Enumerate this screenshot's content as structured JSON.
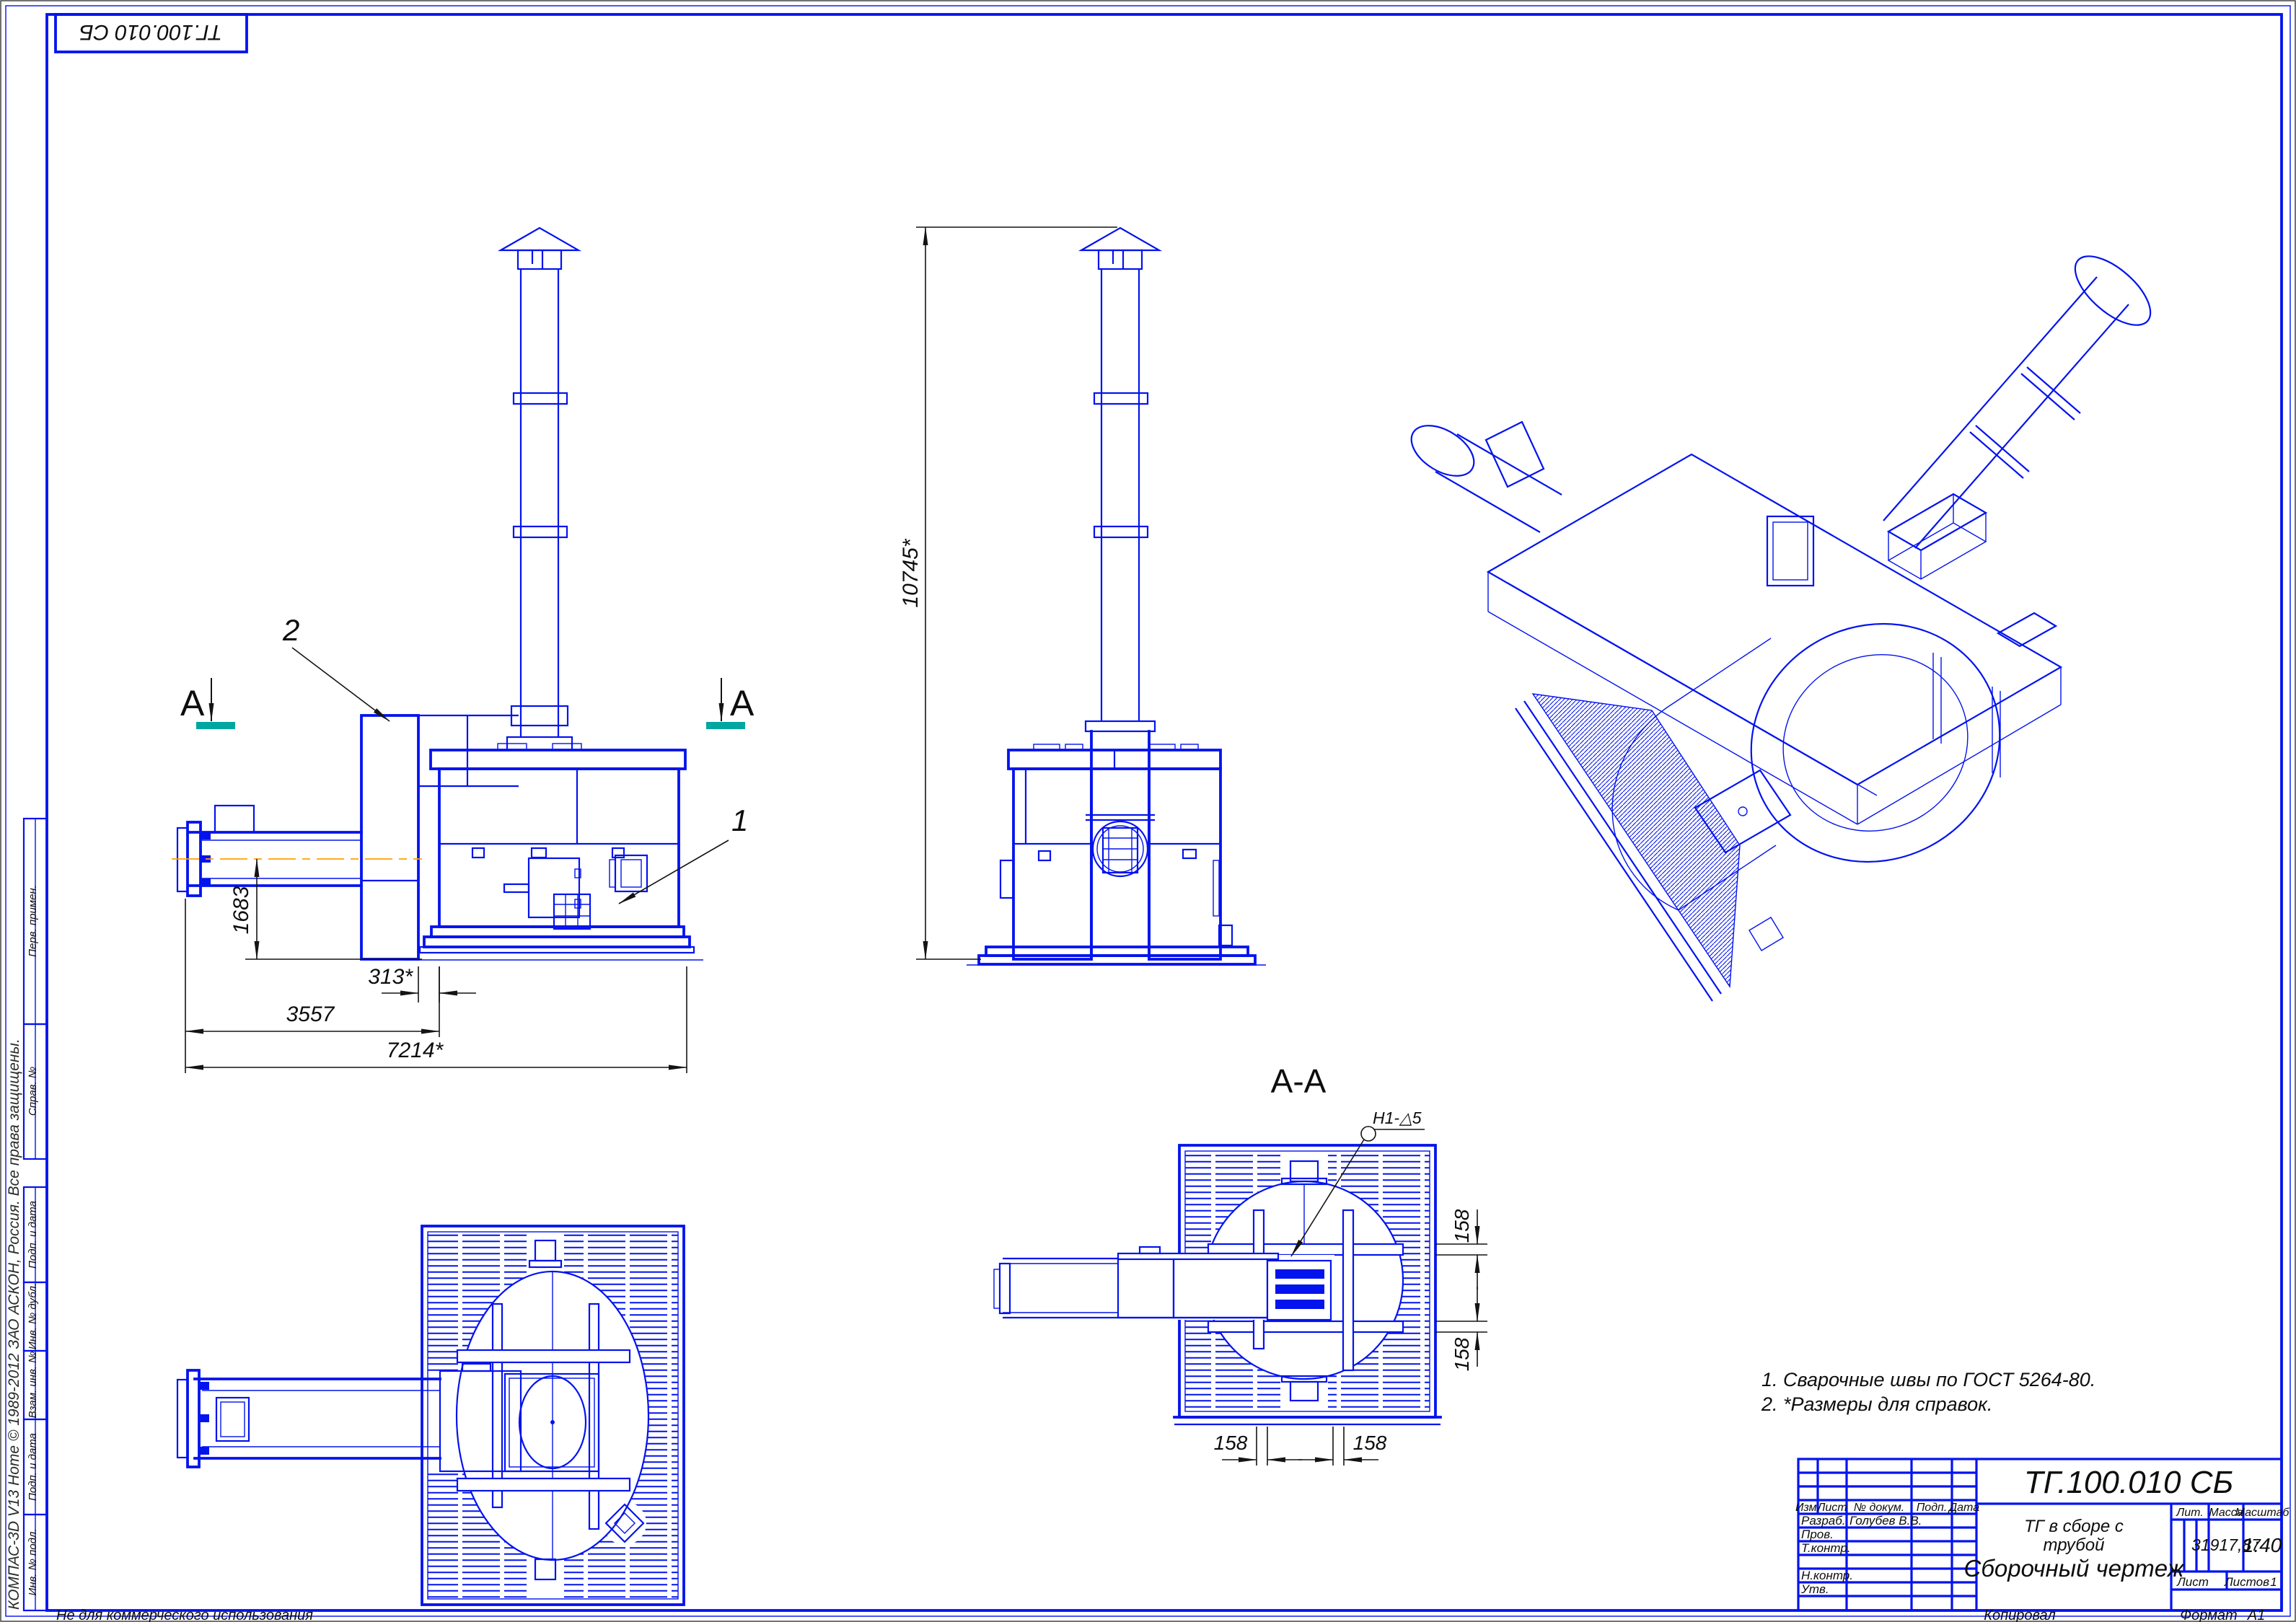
{
  "sheet": {
    "stamp_top_left": "ТГ.100.010 СБ",
    "watermark": "КОМПАС-3D V13 Home © 1989-2012 ЗАО АСКОН, Россия. Все права защищены.",
    "footer_note": "Не для коммерческого использования",
    "kopiroval": "Копировал",
    "format_label": "Формат",
    "format_value": "А1"
  },
  "frame_labels": [
    "Перв. примен.",
    "Справ. №",
    "Подп. и дата",
    "Инв. № дубл.",
    "Взам. инв. №",
    "Подп. и дата",
    "Инв. № подл."
  ],
  "views": {
    "section_title": "А-А",
    "section_letter": "А",
    "pos1": "1",
    "pos2": "2",
    "weld_note": "Н1-△5"
  },
  "dims": {
    "pipe_height": "1683",
    "gap": "313*",
    "mid": "3557",
    "total": "7214*",
    "height": "10745*",
    "s158": "158"
  },
  "notes": {
    "n1": "1. Сварочные швы по ГОСТ 5264-80.",
    "n2": "2. *Размеры для справок."
  },
  "title_block": {
    "designation": "ТГ.100.010 СБ",
    "name_l1": "ТГ в сборе с",
    "name_l2": "трубой",
    "doc_type": "Сборочный чертеж",
    "h_izm": "Изм.",
    "h_list": "Лист",
    "h_ndoc": "№ докум.",
    "h_podp": "Подп.",
    "h_data": "Дата",
    "r_razrab": "Разраб.",
    "r_prov": "Пров.",
    "r_tkontr": "Т.контр.",
    "r_nkontr": "Н.контр.",
    "r_utv": "Утв.",
    "razrab_name": "Голубев В.В.",
    "lit": "Лит.",
    "massa": "Масса",
    "masshtab": "Масштаб",
    "massa_value": "31917,87",
    "masshtab_value": "1:40",
    "list_label": "Лист",
    "listov_label": "Листов",
    "listov_value": "1",
    "accent_blue": "#0313ee",
    "centerline_orange": "#ffa100",
    "section_mark_teal": "#00a6a0"
  }
}
